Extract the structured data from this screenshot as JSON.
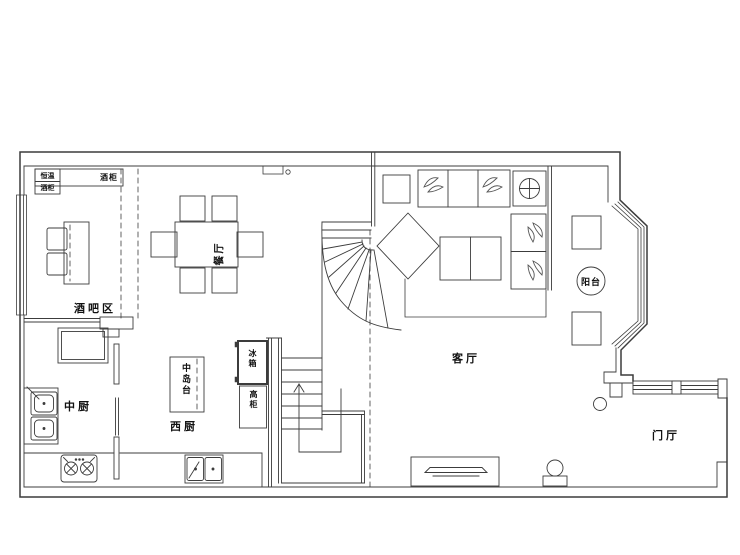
{
  "rooms": {
    "bar": {
      "label": "酒吧区"
    },
    "dining": {
      "label": "餐厅"
    },
    "chinese_kitchen": {
      "label": "中厨"
    },
    "western_kitchen": {
      "label": "西厨"
    },
    "living": {
      "label": "客厅"
    },
    "balcony": {
      "label": "阳台"
    },
    "foyer": {
      "label": "门厅"
    }
  },
  "fixtures": {
    "wine_cabinet_cell_top": "恒温",
    "wine_cabinet_cell_bottom": "酒柜",
    "wine_cabinet": "酒柜",
    "island": "中岛台",
    "fridge": "冰箱",
    "tall_cabinet": "高柜"
  },
  "colors": {
    "background": "#ffffff",
    "wall_line": "#3c3c3c",
    "furniture_line": "#555555"
  }
}
